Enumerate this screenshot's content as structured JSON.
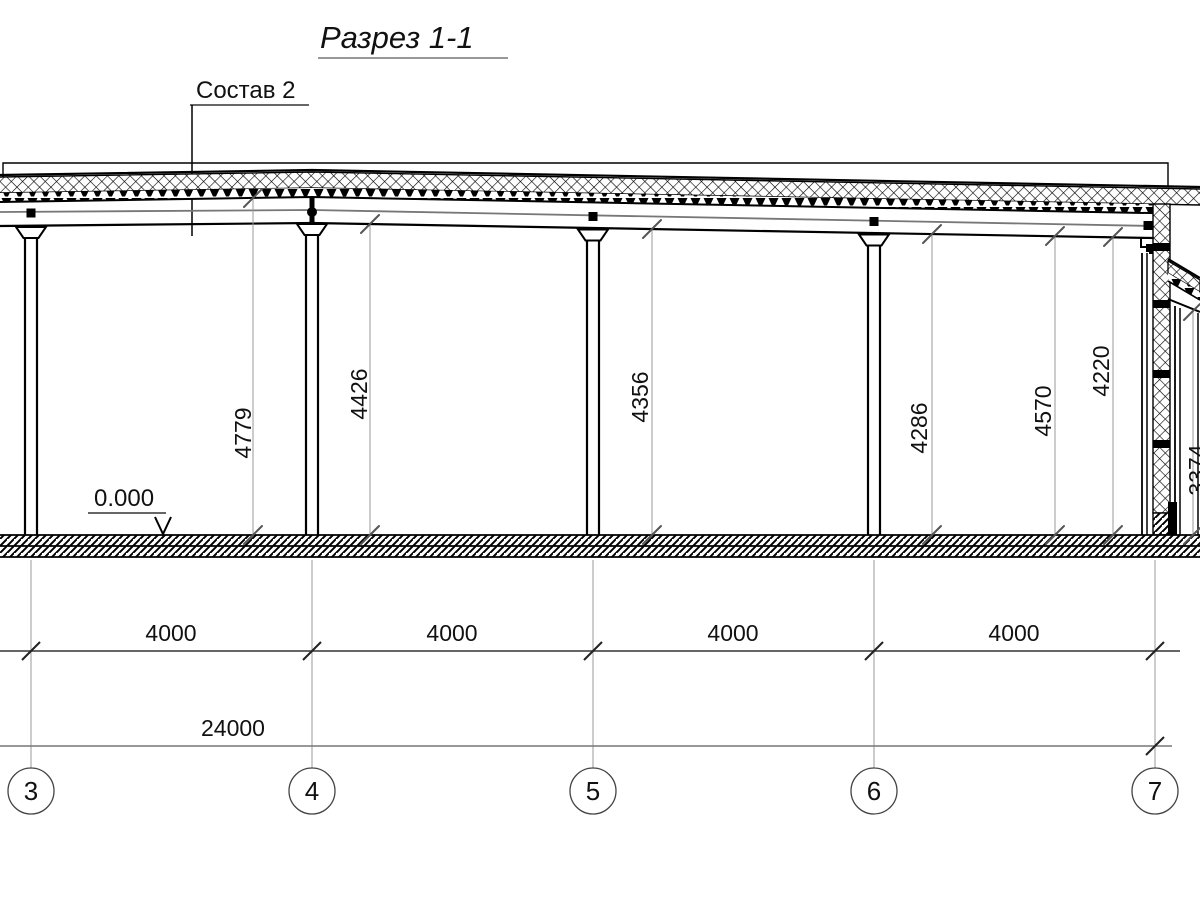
{
  "drawing": {
    "title": "Разрез 1-1",
    "callout": "Состав 2",
    "level_mark": "0.000"
  },
  "vertical_dimensions": [
    {
      "value": "4779"
    },
    {
      "value": "4426"
    },
    {
      "value": "4356"
    },
    {
      "value": "4286"
    },
    {
      "value": "4570"
    },
    {
      "value": "4220"
    },
    {
      "value": "3374"
    }
  ],
  "bay_dimensions": [
    {
      "value": "4000"
    },
    {
      "value": "4000"
    },
    {
      "value": "4000"
    },
    {
      "value": "4000"
    }
  ],
  "total_dimension": "24000",
  "axes": [
    {
      "label": "3"
    },
    {
      "label": "4"
    },
    {
      "label": "5"
    },
    {
      "label": "6"
    },
    {
      "label": "7"
    }
  ],
  "colors": {
    "line": "#000000",
    "extension_line": "#999999",
    "dim_line": "#333333",
    "background": "#ffffff"
  }
}
